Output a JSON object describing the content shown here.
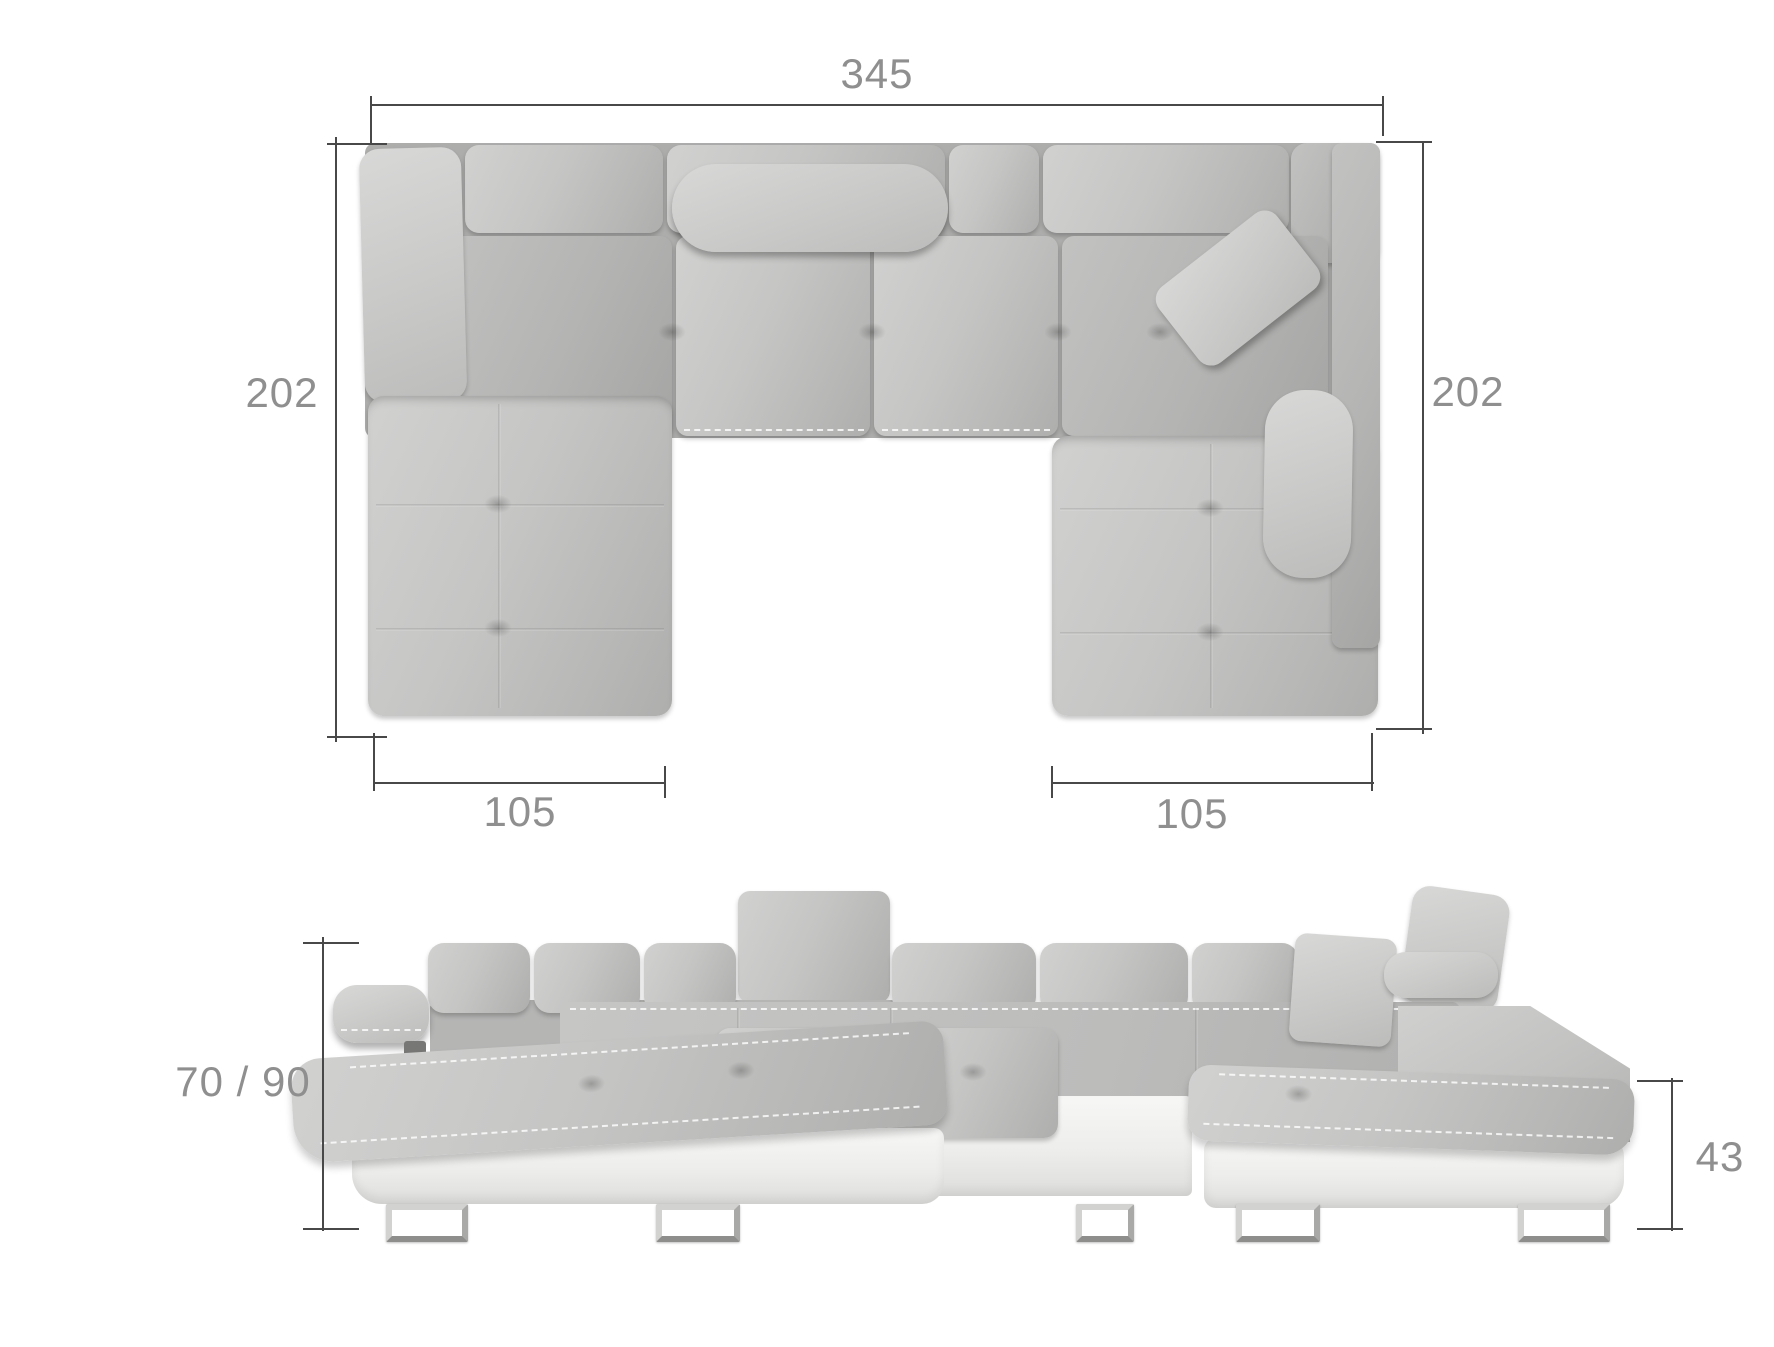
{
  "dimensions": {
    "top_width": "345",
    "left_depth": "202",
    "right_depth": "202",
    "left_chaise_width": "105",
    "right_chaise_width": "105",
    "front_height": "70 / 90",
    "front_seat_height": "43"
  },
  "colors": {
    "fabric": "#c3c3c2",
    "fabric_shadow": "#a9a9a8",
    "base_white": "#f3f3f2",
    "dimension_line": "#484848",
    "dimension_text": "#8f8f8f"
  }
}
